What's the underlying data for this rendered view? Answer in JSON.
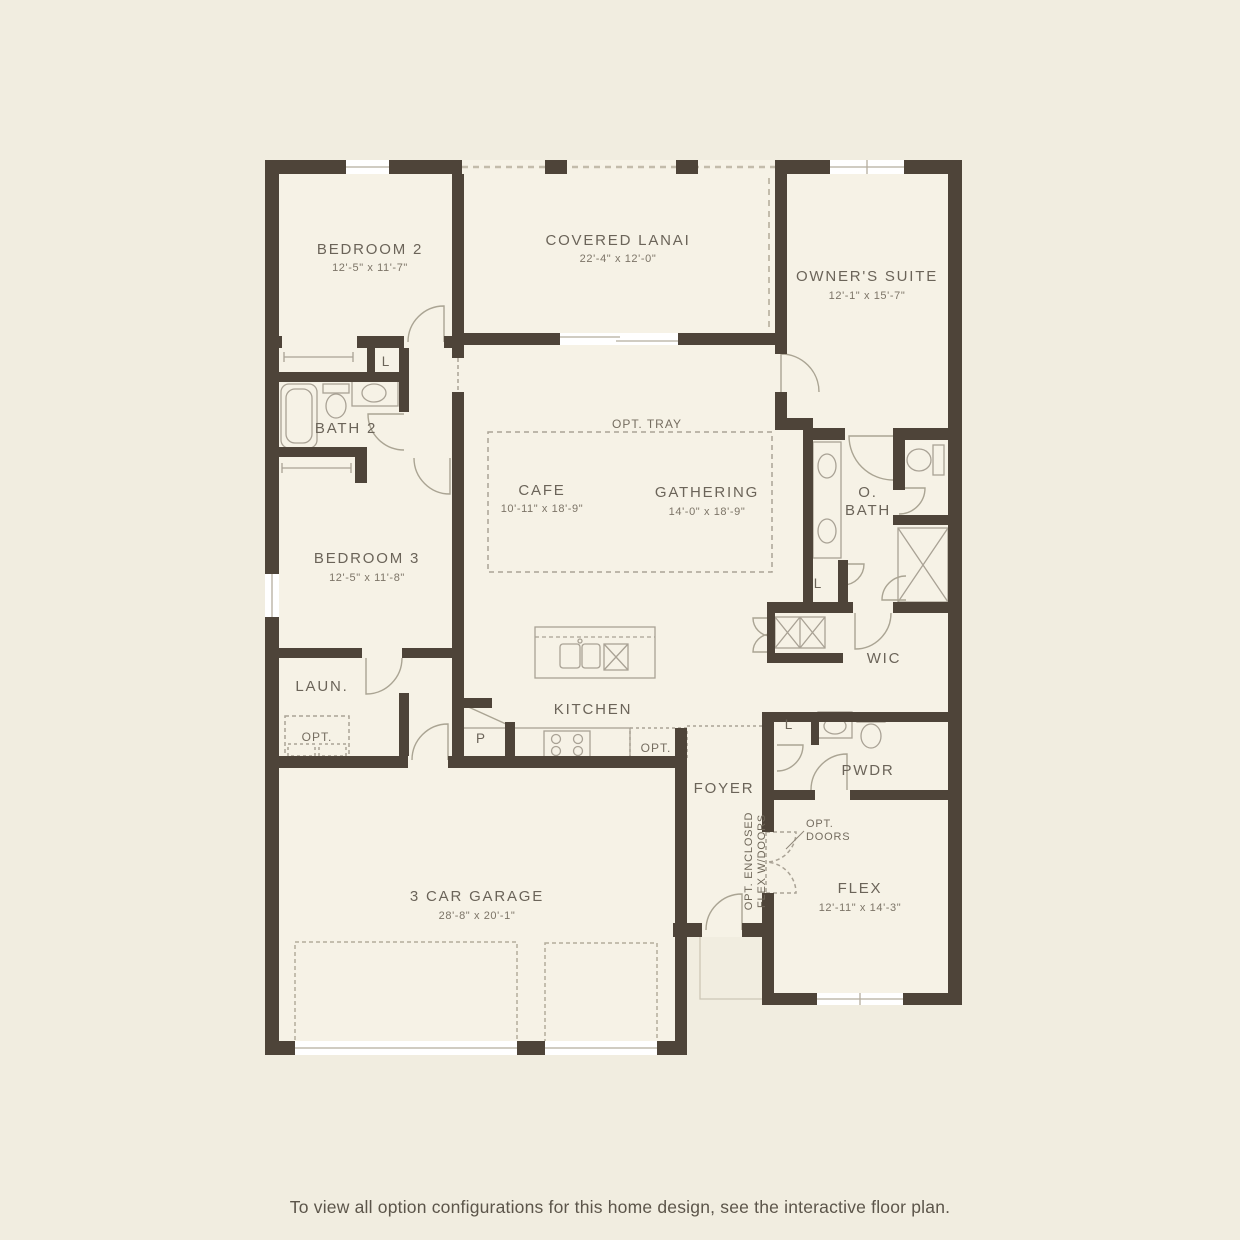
{
  "colors": {
    "background": "#f1ede0",
    "interior_fill": "#f6f2e6",
    "wall": "#4e4439",
    "fixture_line": "#a9a295",
    "dashed_line": "#aaa396",
    "label_text": "#6b6459",
    "dimension_text": "#7c7467",
    "footer_text": "#5c554a"
  },
  "rooms": {
    "bedroom2": {
      "label": "BEDROOM 2",
      "dims": "12'-5\" x 11'-7\""
    },
    "covered_lanai": {
      "label": "COVERED LANAI",
      "dims": "22'-4\" x 12'-0\""
    },
    "owners_suite": {
      "label": "OWNER'S SUITE",
      "dims": "12'-1\" x 15'-7\""
    },
    "bath2": {
      "label": "BATH 2"
    },
    "cafe": {
      "label": "CAFE",
      "dims": "10'-11\" x 18'-9\""
    },
    "gathering": {
      "label": "GATHERING",
      "dims": "14'-0\" x 18'-9\""
    },
    "owners_bath": {
      "label_line1": "O.",
      "label_line2": "BATH"
    },
    "bedroom3": {
      "label": "BEDROOM 3",
      "dims": "12'-5\" x 11'-8\""
    },
    "wic": {
      "label": "WIC"
    },
    "laundry": {
      "label": "LAUN."
    },
    "kitchen": {
      "label": "KITCHEN"
    },
    "pantry": {
      "label": "P"
    },
    "powder": {
      "label": "PWDR"
    },
    "foyer": {
      "label": "FOYER"
    },
    "flex": {
      "label": "FLEX",
      "dims": "12'-11\" x 14'-3\""
    },
    "garage": {
      "label": "3 CAR GARAGE",
      "dims": "28'-8\" x 20'-1\""
    }
  },
  "annotations": {
    "opt_tray": "OPT. TRAY",
    "linen": "L",
    "opt": "OPT.",
    "opt_doors_line1": "OPT.",
    "opt_doors_line2": "DOORS",
    "opt_enclosed_line1": "OPT. ENCLOSED",
    "opt_enclosed_line2": "FLEX W/DOORS"
  },
  "footer": {
    "note": "To view all option configurations for this home design, see the interactive floor plan."
  }
}
